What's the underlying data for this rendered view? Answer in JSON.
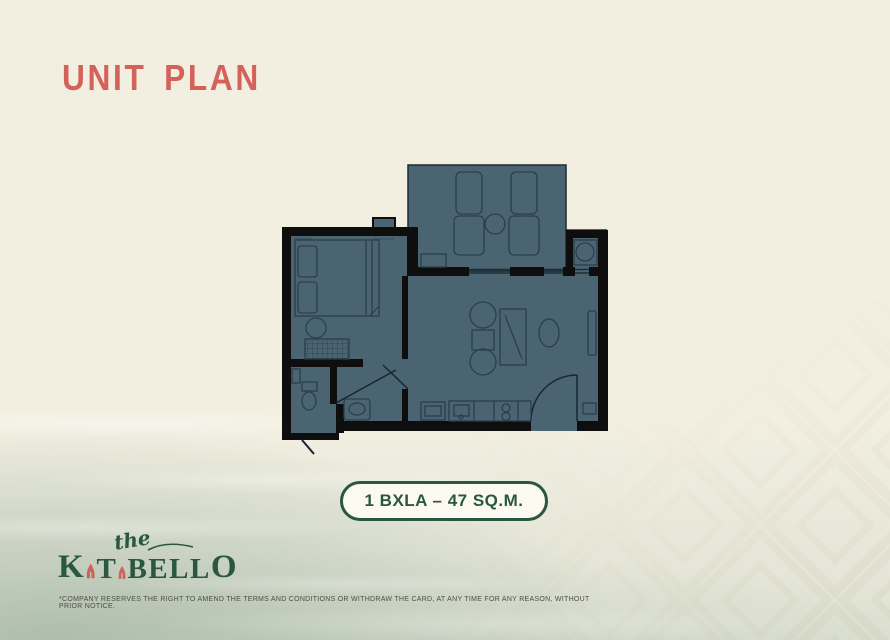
{
  "slide": {
    "title": "UNIT PLAN"
  },
  "unit_badge": {
    "label": "1 BXLA – 47 SQ.M."
  },
  "brand": {
    "the": "the",
    "k": "K",
    "t": "T",
    "bell": "BELL",
    "o": "O"
  },
  "disclaimer": "*COMPANY RESERVES THE RIGHT TO AMEND THE TERMS AND CONDITIONS OR WITHDRAW THE CARD, AT ANY TIME FOR ANY REASON, WITHOUT PRIOR NOTICE.",
  "floor_plan": {
    "unit_label": "1 BXLA – 47 SQ.M.",
    "elements": [
      "balcony",
      "sun-lounger",
      "sun-lounger",
      "round-table",
      "planter",
      "washer",
      "bed",
      "pillow",
      "pillow",
      "nightstand",
      "wardrobe",
      "toilet",
      "vanity-sink",
      "lounge-chair",
      "coffee-table",
      "lounge-chair",
      "tv-cabinet",
      "dining-table",
      "side-cabinet",
      "kitchen-counter",
      "kitchen-sink",
      "stove",
      "entry-door",
      "balcony-sliding-door",
      "bathroom-door"
    ]
  },
  "colors": {
    "accent_red": "#d4625b",
    "brand_green": "#2a5741",
    "plan_fill": "#4b6472",
    "plan_wall": "#0e0e0e",
    "plan_line": "#29404c",
    "background": "#f2efe1",
    "badge_bg": "#fcf9f0"
  }
}
